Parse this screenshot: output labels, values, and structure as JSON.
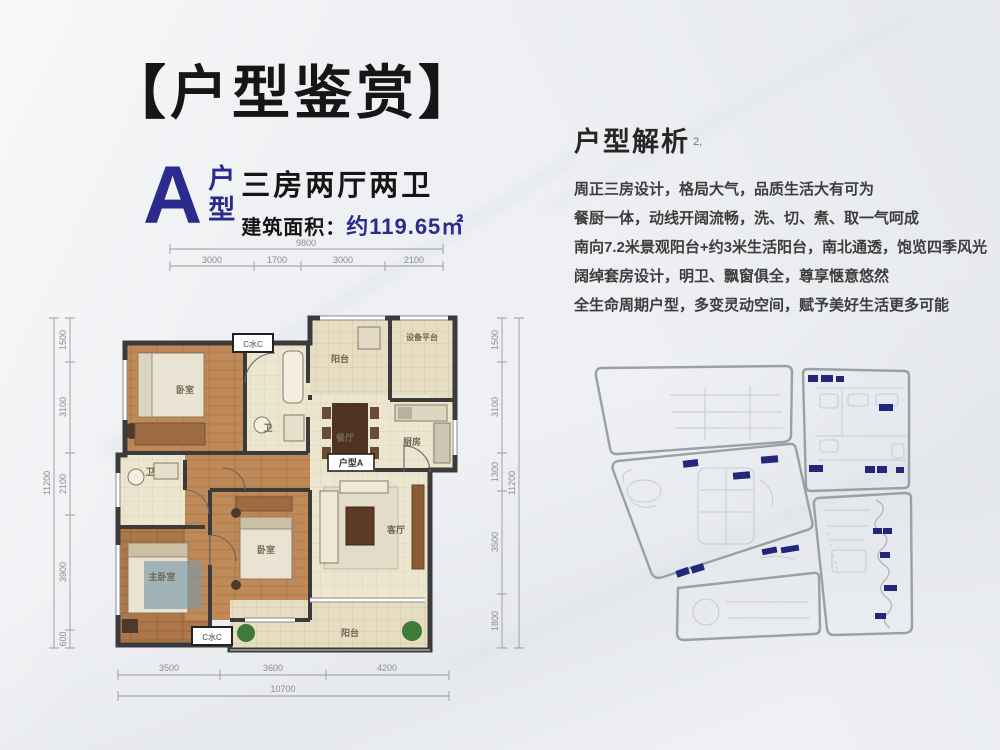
{
  "header": {
    "title": "【户型鉴赏】"
  },
  "unit": {
    "letter": "A",
    "type_top": "户",
    "type_bottom": "型",
    "layout": "三房两厅两卫",
    "area_label": "建筑面积：",
    "area_value": "约119.65㎡"
  },
  "analysis": {
    "heading": "户型解析",
    "mark": "2,",
    "lines": [
      "周正三房设计，格局大气，品质生活大有可为",
      "餐厨一体，动线开阔流畅，洗、切、煮、取一气呵成",
      "南向7.2米景观阳台+约3米生活阳台，南北通透，饱览四季风光",
      "阔绰套房设计，明卫、飘窗俱全，尊享惬意悠然",
      "全生命周期户型，多变灵动空间，赋予美好生活更多可能"
    ]
  },
  "floorplan": {
    "dims": {
      "top_total": "9800",
      "top_segments": [
        "3000",
        "1700",
        "3000",
        "2100"
      ],
      "left_total": "11200",
      "left_segments": [
        "1500",
        "3100",
        "2100",
        "3900",
        "600"
      ],
      "right_total": "11200",
      "right_segments": [
        "1500",
        "3100",
        "1300",
        "3500",
        "1800"
      ],
      "bottom_total": "10700",
      "bottom_segments": [
        "3500",
        "3600",
        "4200"
      ]
    },
    "rooms": {
      "bedroom_top": "卧室",
      "bath_top": "卫",
      "balcony_north": "阳台",
      "equipment": "设备平台",
      "kitchen": "厨房",
      "dining": "餐厅",
      "unit_tag": "户型A",
      "bath_master": "卫",
      "master": "主卧室",
      "bedroom_mid": "卧室",
      "living": "客厅",
      "balcony_south": "阳台",
      "window_tag_top": "C水C",
      "window_tag_bottom": "C水C"
    }
  },
  "colors": {
    "navy": "#2a2b8d",
    "ink": "#161616",
    "body_text": "#3d3d3d",
    "wall": "#3b3b3b",
    "wood": "#c08a58",
    "tile": "#ece5d0",
    "dim_line": "#9a9a9a",
    "site_outline": "#9aa0a6",
    "site_block": "#23277b"
  }
}
